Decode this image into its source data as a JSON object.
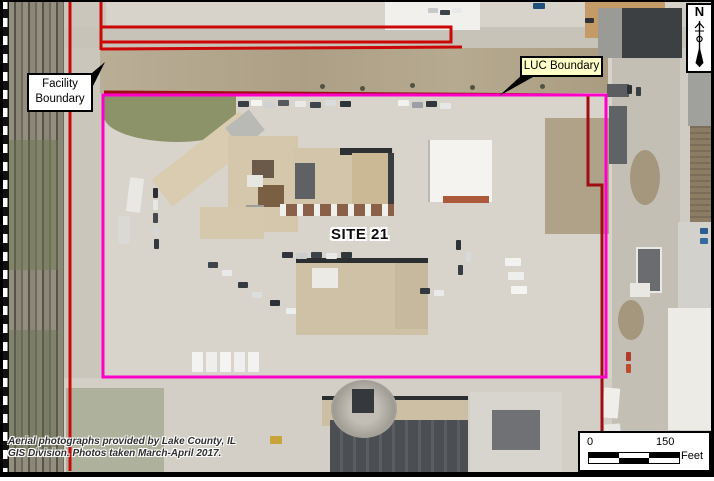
{
  "map": {
    "site_label": "SITE 21",
    "facility_label": {
      "line1": "Facility",
      "line2": "Boundary"
    },
    "luc_label": "LUC Boundary",
    "north": {
      "letter": "N"
    },
    "scale_bar": {
      "start": "0",
      "end": "150",
      "unit": "Feet"
    },
    "attribution": {
      "line1": "Aerial photographs provided by Lake County, IL",
      "line2": "GIS Division. Photos taken March-April 2017."
    },
    "colors": {
      "facility_boundary": "#CC0707",
      "facility_boundary_dark": "#9E0E12",
      "luc_boundary": "#FF00C8",
      "luc_label_bg": "#FFFFC8"
    }
  }
}
